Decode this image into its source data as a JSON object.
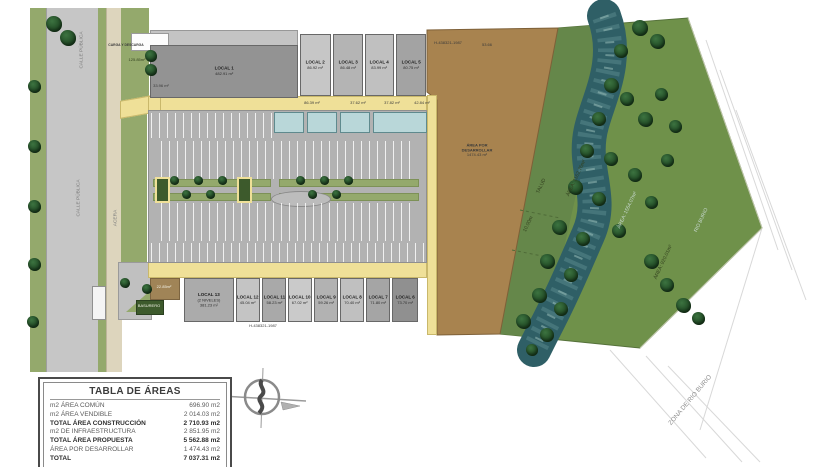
{
  "colors": {
    "road": "#c6c6c6",
    "sidewalk": "#ddd5bd",
    "verge": "#94a96c",
    "yellow": "#efe098",
    "parking": "#b2b2b2",
    "canopy": "#b9d7d9",
    "develop": "#a8834f",
    "greenzone": "#6f914a",
    "talud": "#65874a",
    "river": "#2f5f66",
    "tree": "#1f4723"
  },
  "plan": {
    "street_name": "CALLE PÚBLICA",
    "sidewalk_label": "ACERA",
    "loading_label": "CARGA Y DESCARGA",
    "front_green_area": "125.85m²",
    "patio_area": "33.96 m²",
    "entry_patch_area": "22.85m²",
    "trash_label": "BASURERO",
    "survey_ref_top": "H-438321-1987",
    "survey_dim_top": "53.66",
    "survey_ref_bottom": "H-438321-1987",
    "locals_top": [
      {
        "name": "LOCAL 1",
        "area": "482.91 m²"
      },
      {
        "name": "LOCAL 2",
        "area": "86.92 m²"
      },
      {
        "name": "LOCAL 3",
        "area": "86.48 m²"
      },
      {
        "name": "LOCAL 4",
        "area": "83.99 m²"
      },
      {
        "name": "LOCAL 5",
        "area": "80.75 m²"
      }
    ],
    "terrace_areas": [
      "86.39 m²",
      "37.62 m²",
      "37.82 m²",
      "42.84 m²"
    ],
    "locals_bottom": [
      {
        "name": "LOCAL 13",
        "sub": "(2 NIVELES)",
        "area": "381.23 m²"
      },
      {
        "name": "LOCAL 12",
        "area": "45.04 m²"
      },
      {
        "name": "LOCAL 11",
        "area": "58.23 m²"
      },
      {
        "name": "LOCAL 10",
        "area": "67.02 m²"
      },
      {
        "name": "LOCAL 9",
        "area": "59.26 m²"
      },
      {
        "name": "LOCAL 8",
        "area": "70.40 m²"
      },
      {
        "name": "LOCAL 7",
        "area": "71.80 m²"
      },
      {
        "name": "LOCAL 6",
        "area": "73.70 m²"
      }
    ],
    "develop": {
      "line1": "ÁREA POR",
      "line2": "DESARROLLAR",
      "area": "1474.43 m²"
    },
    "slope_label": "TALUD",
    "slope_area": "ÁREA: 1162.76m²",
    "slope_offset": "10.00m",
    "river_area": "ÁREA: 1554.07m²",
    "river_name": "RIO BURIO",
    "east_green_area": "ÁREA: 920.01m²",
    "zone_label": "ZONA DE RIO BURIO"
  },
  "areas_table": {
    "title": "TABLA DE ÁREAS",
    "rows": [
      {
        "label": "m2 ÁREA COMÚN",
        "value": "696.90 m2"
      },
      {
        "label": "m2 ÁREA VENDIBLE",
        "value": "2 014.03 m2"
      },
      {
        "label": "TOTAL ÁREA CONSTRUCCIÓN",
        "value": "2 710.93 m2"
      },
      {
        "label": "m2 DE INFRAESTRUCTURA",
        "value": "2 851.95 m2"
      },
      {
        "label": "TOTAL ÁREA PROPUESTA",
        "value": "5 562.88 m2"
      },
      {
        "label": "ÁREA POR DESARROLLAR",
        "value": "1 474.43 m2"
      },
      {
        "label": "TOTAL",
        "value": "7 037.31 m2"
      }
    ]
  }
}
